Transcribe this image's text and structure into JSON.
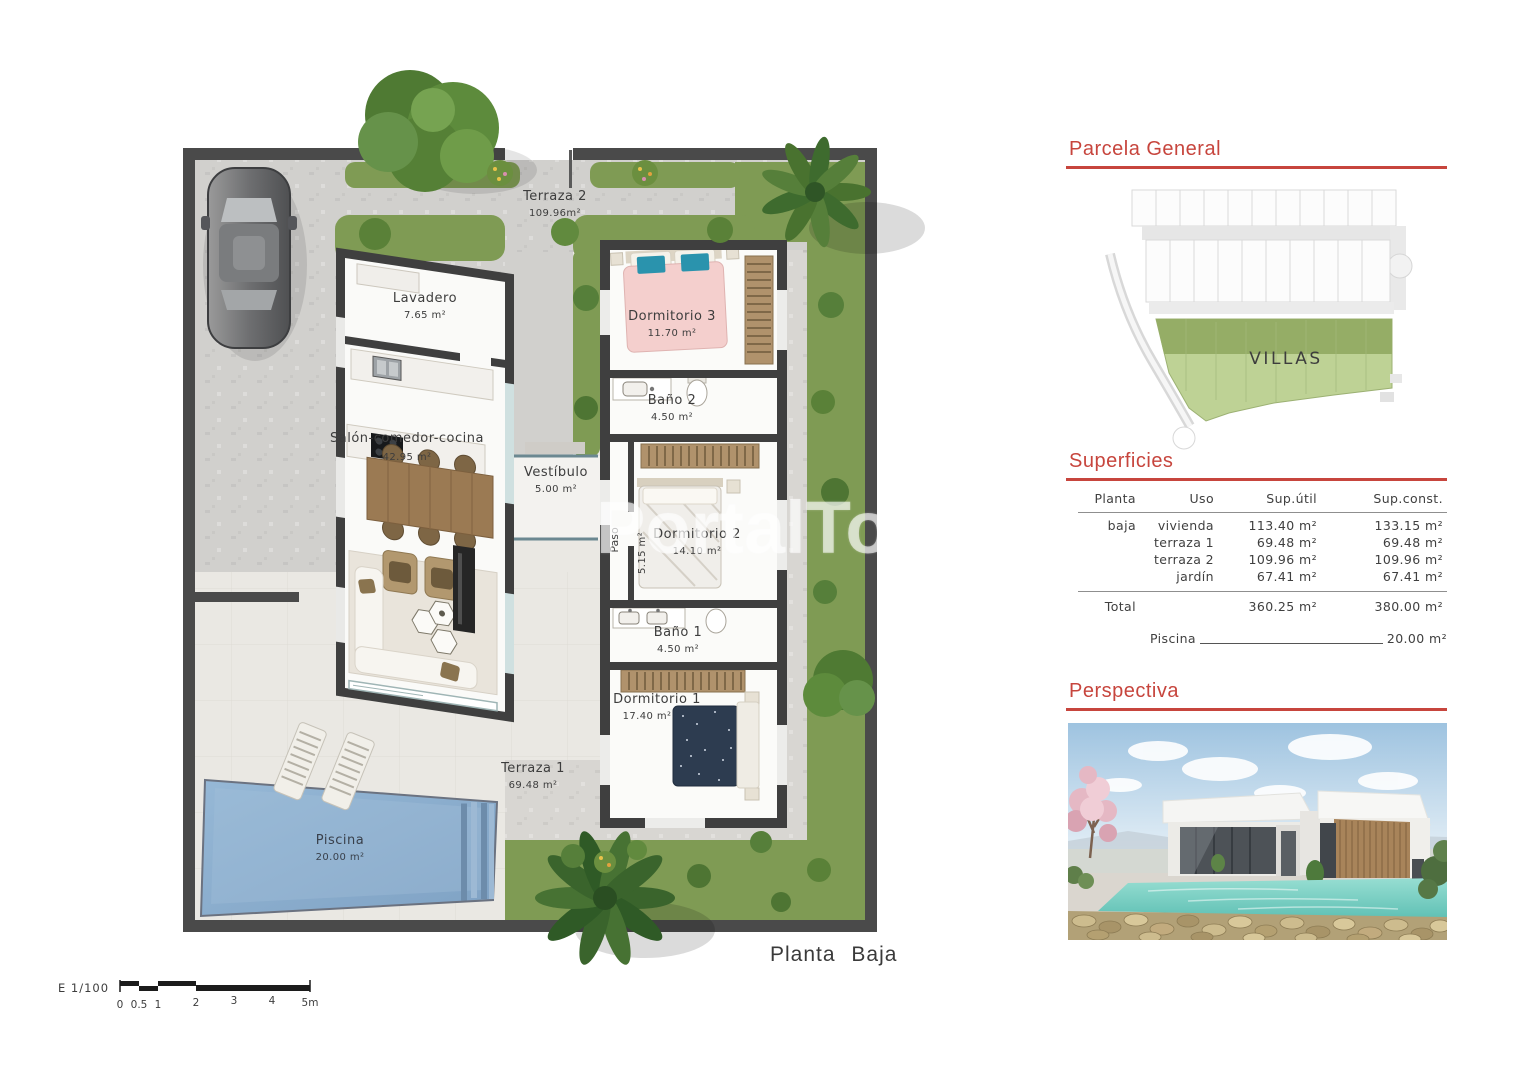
{
  "watermark": "PortalTo",
  "plan": {
    "title": "Planta Baja",
    "scale": {
      "label": "E 1/100",
      "ticks": [
        "0",
        "0.5",
        "1",
        "2",
        "3",
        "4",
        "5m"
      ]
    },
    "rooms": {
      "terraza2": {
        "name": "Terraza 2",
        "area": "109.96m²"
      },
      "lavadero": {
        "name": "Lavadero",
        "area": "7.65 m²"
      },
      "dormitorio3": {
        "name": "Dormitorio 3",
        "area": "11.70 m²"
      },
      "bano2": {
        "name": "Baño 2",
        "area": "4.50 m²"
      },
      "salon": {
        "name": "Salón-comedor-cocina",
        "area": "42.95 m²"
      },
      "vestibulo": {
        "name": "Vestíbulo",
        "area": "5.00 m²"
      },
      "paso": {
        "name": "Paso",
        "area": "5.15 m²"
      },
      "dormitorio2": {
        "name": "Dormitorio 2",
        "area": "14.10 m²"
      },
      "bano1": {
        "name": "Baño 1",
        "area": "4.50 m²"
      },
      "dormitorio1": {
        "name": "Dormitorio 1",
        "area": "17.40 m²"
      },
      "terraza1": {
        "name": "Terraza 1",
        "area": "69.48 m²"
      },
      "piscina": {
        "name": "Piscina",
        "area": "20.00 m²"
      }
    }
  },
  "sidebar": {
    "parcela": {
      "title": "Parcela General",
      "map_label": "VILLAS"
    },
    "superficies": {
      "title": "Superficies",
      "columns": [
        "Planta",
        "Uso",
        "Sup.útil",
        "Sup.const."
      ],
      "rows": [
        {
          "planta": "baja",
          "uso": "vivienda",
          "util": "113.40 m²",
          "const": "133.15 m²"
        },
        {
          "planta": "",
          "uso": "terraza 1",
          "util": "69.48 m²",
          "const": "69.48 m²"
        },
        {
          "planta": "",
          "uso": "terraza 2",
          "util": "109.96 m²",
          "const": "109.96 m²"
        },
        {
          "planta": "",
          "uso": "jardín",
          "util": "67.41 m²",
          "const": "67.41 m²"
        }
      ],
      "total": {
        "label": "Total",
        "util": "360.25 m²",
        "const": "380.00 m²"
      },
      "piscina": {
        "label": "Piscina",
        "value": "20.00 m²"
      }
    },
    "perspectiva": {
      "title": "Perspectiva"
    }
  },
  "colors": {
    "accent_red": "#c7453d",
    "grass": "#7f9b54",
    "pool": "#8aaed0",
    "wall": "#4a4a4a"
  }
}
